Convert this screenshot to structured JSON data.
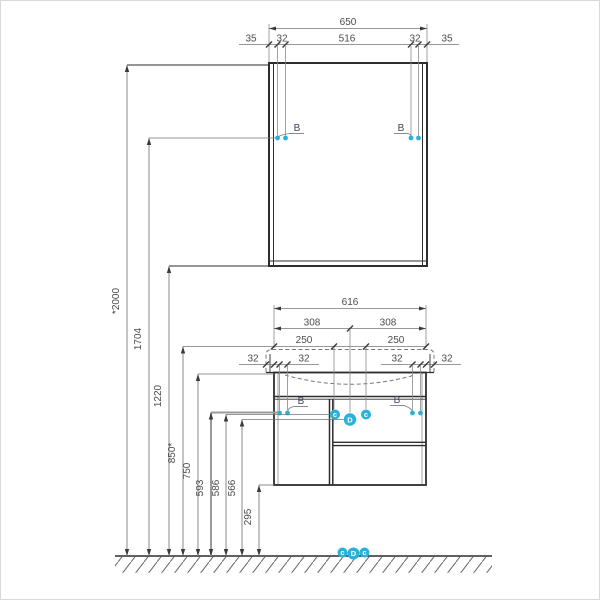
{
  "drawing_title": "bathroom-vanity-and-mirror-installation-dimensions",
  "colors": {
    "accent": "#29b2d8",
    "object_line": "#2d2d2d",
    "dimension_line": "#747474",
    "text": "#4c4c4c"
  },
  "dims": {
    "mirror": {
      "total": "650",
      "left_margin": "35",
      "left_hole": "32",
      "center_span": "516",
      "right_hole": "32",
      "right_margin": "35"
    },
    "cabinet": {
      "total": "616",
      "half_left": "308",
      "half_right": "308",
      "left_250": "250",
      "right_250": "250",
      "overhang_left": "32",
      "holes_left": "32",
      "holes_right": "32",
      "overhang_right": "32"
    },
    "heights": {
      "h2000": "*2000",
      "h1704": "1704",
      "h1220": "1220",
      "h850": "850*",
      "h750": "750",
      "h593": "593",
      "h586": "586",
      "h566": "566",
      "h295": "295"
    }
  },
  "callouts": {
    "hanger": "B",
    "c_left": "c",
    "d_center": "D",
    "c_right": "c",
    "floor_c_left": "c",
    "floor_d_center": "D",
    "floor_c_right": "c"
  }
}
